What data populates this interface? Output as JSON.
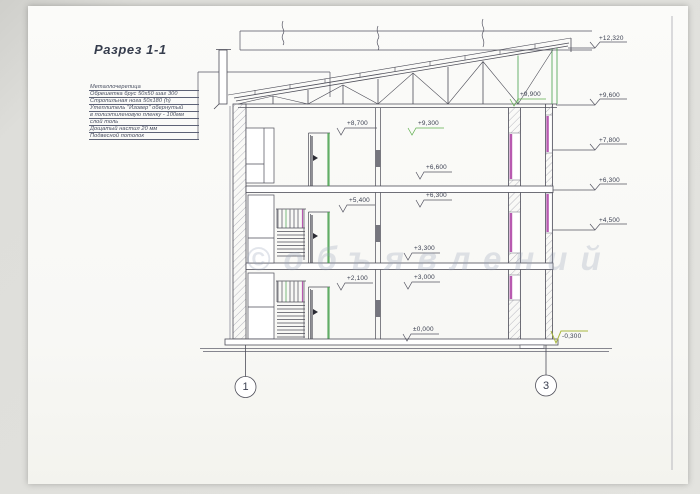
{
  "title": "Разрез 1-1",
  "watermark": "©объявлений",
  "notes": [
    "Металлочерепица",
    "Обрешетка брус 50х50 шаг 300",
    "Стропильная нога 50х180 (h)",
    "Утеплитель \"Изовер\" обернутый",
    "в полиэтиленовую пленку - 100мм",
    "слой толь",
    "Дощатый настил 20 мм",
    "Подвесной потолок"
  ],
  "elevations": {
    "right": [
      "+12,320",
      "+9,600",
      "+7,800",
      "+6,300",
      "+4,500",
      "-0,300"
    ],
    "interior": [
      "+9,900",
      "+8,700",
      "+9,300",
      "+6,600",
      "+5,400",
      "+6,300",
      "+3,300",
      "+3,000",
      "+2,100",
      "±0,000"
    ]
  },
  "axes": [
    "1",
    "3"
  ],
  "colors": {
    "line": "#4d4d58",
    "hatch": "#8d8d9a",
    "green": "#46a04c",
    "magenta": "#b85ab0",
    "flag_green": "#5fae4e",
    "flag_yellow": "#a9b83e"
  }
}
